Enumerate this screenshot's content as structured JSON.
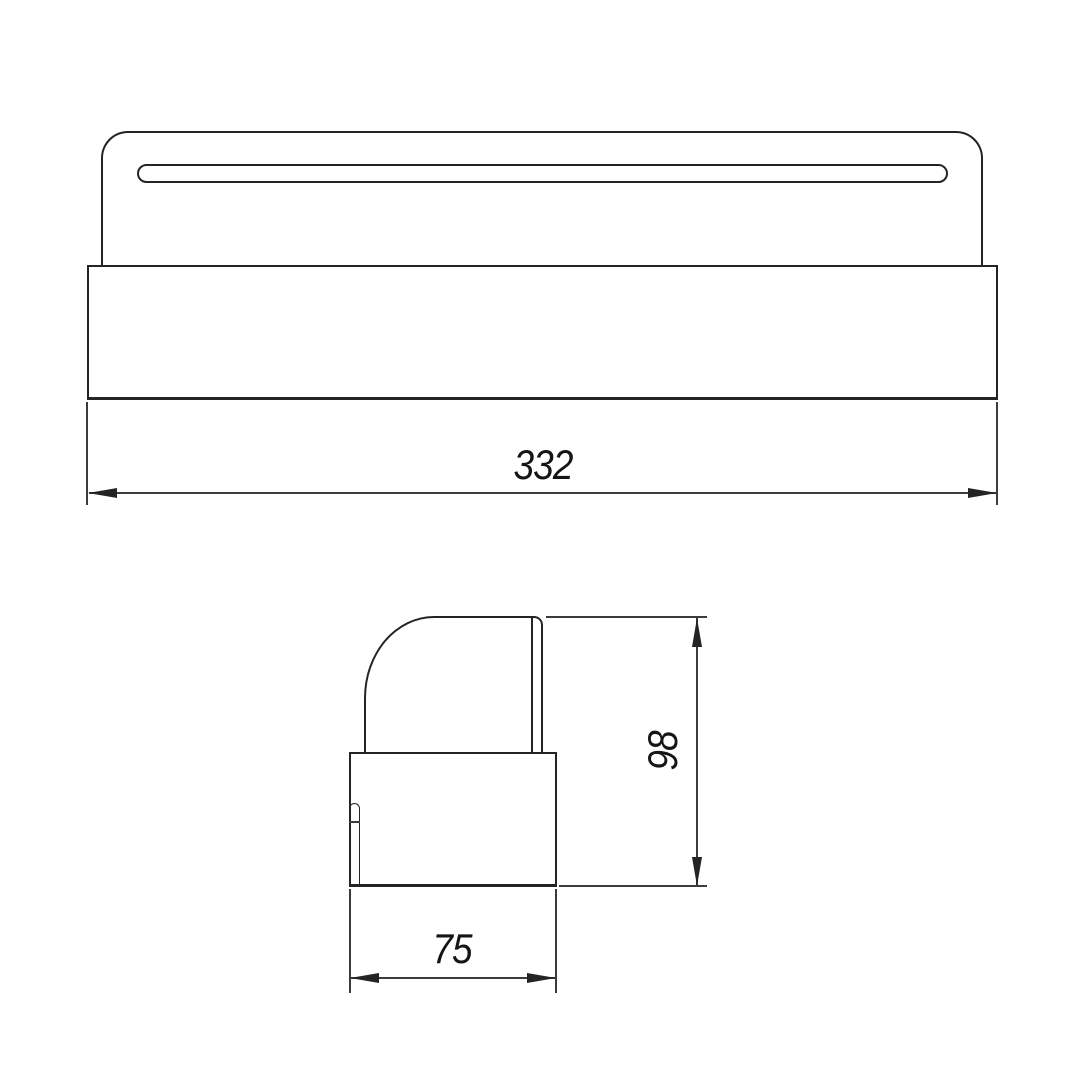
{
  "drawing": {
    "background_color": "#ffffff",
    "outline_color": "#242424",
    "thin_line_color": "#3c3c3c",
    "dimensions": {
      "overall_width": "332",
      "side_height": "98",
      "side_depth": "75"
    }
  }
}
